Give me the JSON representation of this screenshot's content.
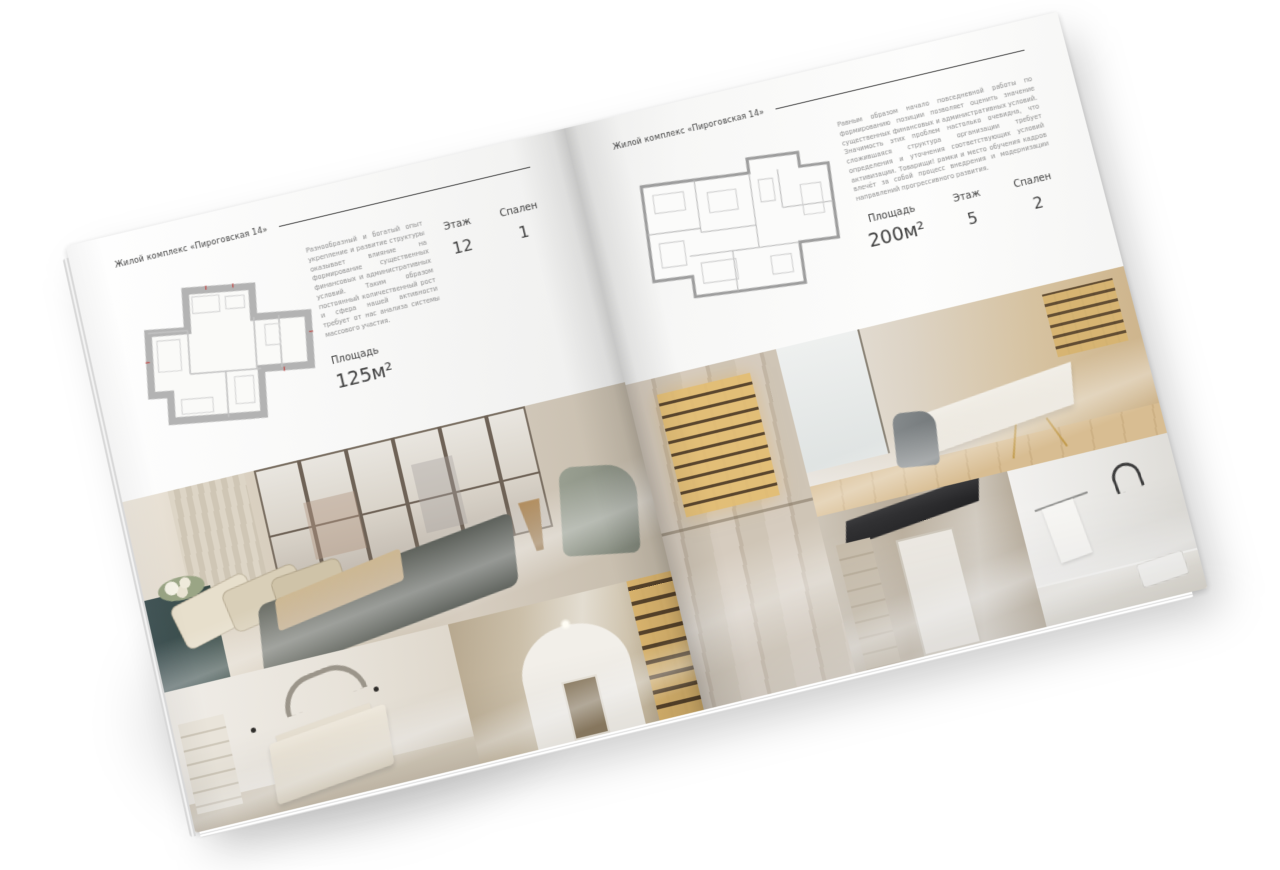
{
  "page_background": "#ffffff",
  "paper_color": "#f7f7f5",
  "text_color": "#3e3e3e",
  "plan_wall_color": "#b3b3b3",
  "spread": {
    "left_page": {
      "header_title": "Жилой комплекс «Пироговская 14»",
      "paragraph": "Разнообразный и богатый опыт укрепление и развитие структуры оказывает влияние на формирование существенных финансовых и административных условий. Таким образом постоянный количественный рост и сфера нашей активности требует от нас анализа системы массового участия.",
      "stats": {
        "area_label": "Площадь",
        "area_value": "125м²",
        "floor_label": "Этаж",
        "floor_value": "12",
        "bedrooms_label": "Спален",
        "bedrooms_value": "1"
      },
      "floor_plan": "floor-plan-1-bedroom",
      "photos": [
        "bedroom-with-panoramic-windows",
        "white-bedroom",
        "arched-hallway-with-bookshelf"
      ]
    },
    "right_page": {
      "header_title": "Жилой комплекс «Пироговская 14»",
      "paragraph": "Равным образом начало повседневной работы по формированию позиции позволяет оценить значение существенных финансовых и административных условий. Значимость этих проблем настолько очевидна, что сложившаяся структура организации требует определения и уточнения соответствующих условий активизации. Товарищи! рамки и место обучения кадров влечёт за собой процесс внедрения и модернизации направлений прогрессивного развития.",
      "stats": {
        "area_label": "Площадь",
        "area_value": "200м²",
        "floor_label": "Этаж",
        "floor_value": "5",
        "bedrooms_label": "Спален",
        "bedrooms_value": "2"
      },
      "floor_plan": "floor-plan-2-bedroom",
      "photos": [
        "wardrobe-hallway-with-lit-shelves",
        "study-with-desk",
        "kitchen-hall-doorway",
        "bathroom"
      ]
    }
  }
}
